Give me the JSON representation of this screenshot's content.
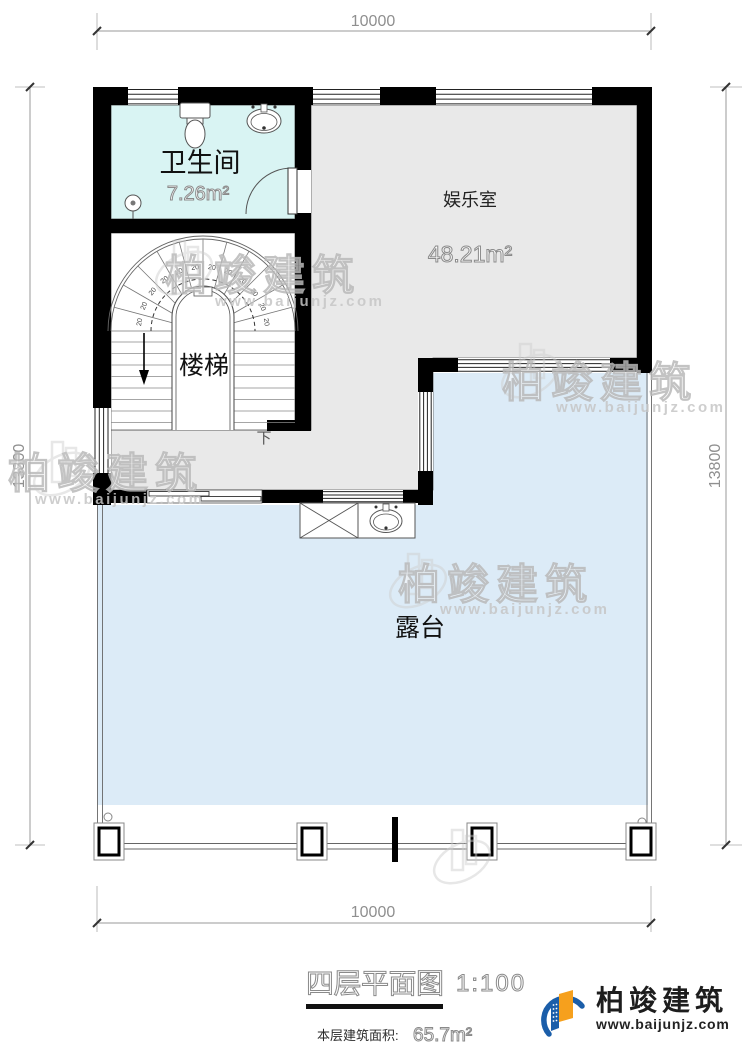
{
  "plan": {
    "dimensions": {
      "top": "10000",
      "bottom": "10000",
      "left": "13800",
      "right": "13800"
    },
    "rooms": {
      "bathroom": {
        "label": "卫生间",
        "area": "7.26m²"
      },
      "entertainment": {
        "label": "娱乐室",
        "area": "48.21m²"
      },
      "stairs": {
        "label": "楼梯",
        "direction": "下",
        "tread": "20"
      },
      "terrace": {
        "label": "露台"
      }
    }
  },
  "title_block": {
    "title": "四层平面图",
    "scale": "1:100",
    "area_label": "本层建筑面积:",
    "area_value": "65.7m²"
  },
  "watermark": {
    "text": "柏竣建筑",
    "url": "www.baijunjz.com"
  },
  "logo": {
    "name": "柏竣建筑",
    "url": "www.baijunjz.com"
  },
  "colors": {
    "wall": "#000000",
    "bathroom_fill": "#d9f4f3",
    "room_fill": "#e9e9e9",
    "terrace_fill": "#dcebf7",
    "logo_blue": "#1b5ea9",
    "logo_orange": "#f6a01d"
  }
}
